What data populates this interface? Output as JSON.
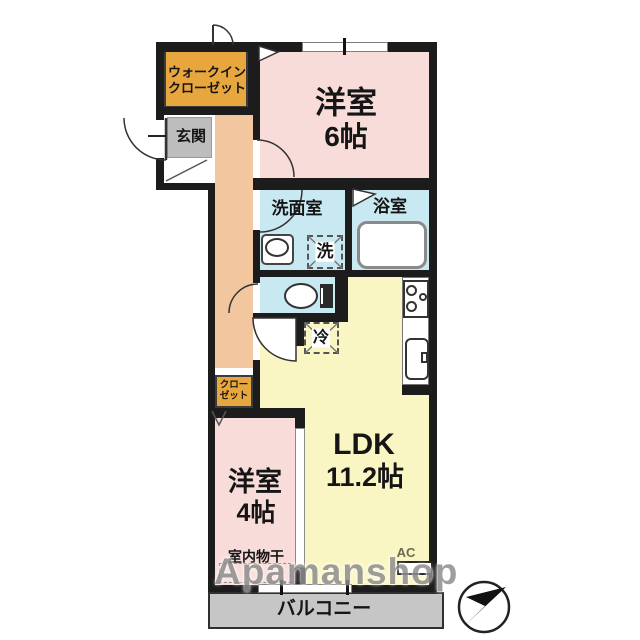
{
  "rooms": {
    "walk_in_closet": {
      "line1": "ウォークイン",
      "line2": "クローゼット"
    },
    "entrance": {
      "label": "玄関"
    },
    "bedroom6": {
      "name": "洋室",
      "size": "6帖"
    },
    "washroom": {
      "label": "洗面室"
    },
    "bathroom": {
      "label": "浴室"
    },
    "ldk": {
      "name": "LDK",
      "size": "11.2帖"
    },
    "closet": {
      "line1": "クロー",
      "line2": "ゼット"
    },
    "bedroom4": {
      "name": "洋室",
      "size": "4帖"
    },
    "balcony": {
      "label": "バルコニー"
    }
  },
  "fixtures": {
    "washer_symbol": "洗",
    "fridge_symbol": "冷",
    "indoor_drying_label": "室内物干",
    "ac_label": "AC"
  },
  "watermark": {
    "text": "Apamanshop"
  },
  "colors": {
    "wall": "#1c1c1c",
    "room-pink": "#f8dcd9",
    "room-yellow": "#faf6c3",
    "corridor": "#f2c79f",
    "closet-orange": "#e7a73e",
    "entry-gray": "#bdbdbd",
    "wet-blue": "#c9e9f2",
    "balcony-gray": "#c6c6c6"
  }
}
